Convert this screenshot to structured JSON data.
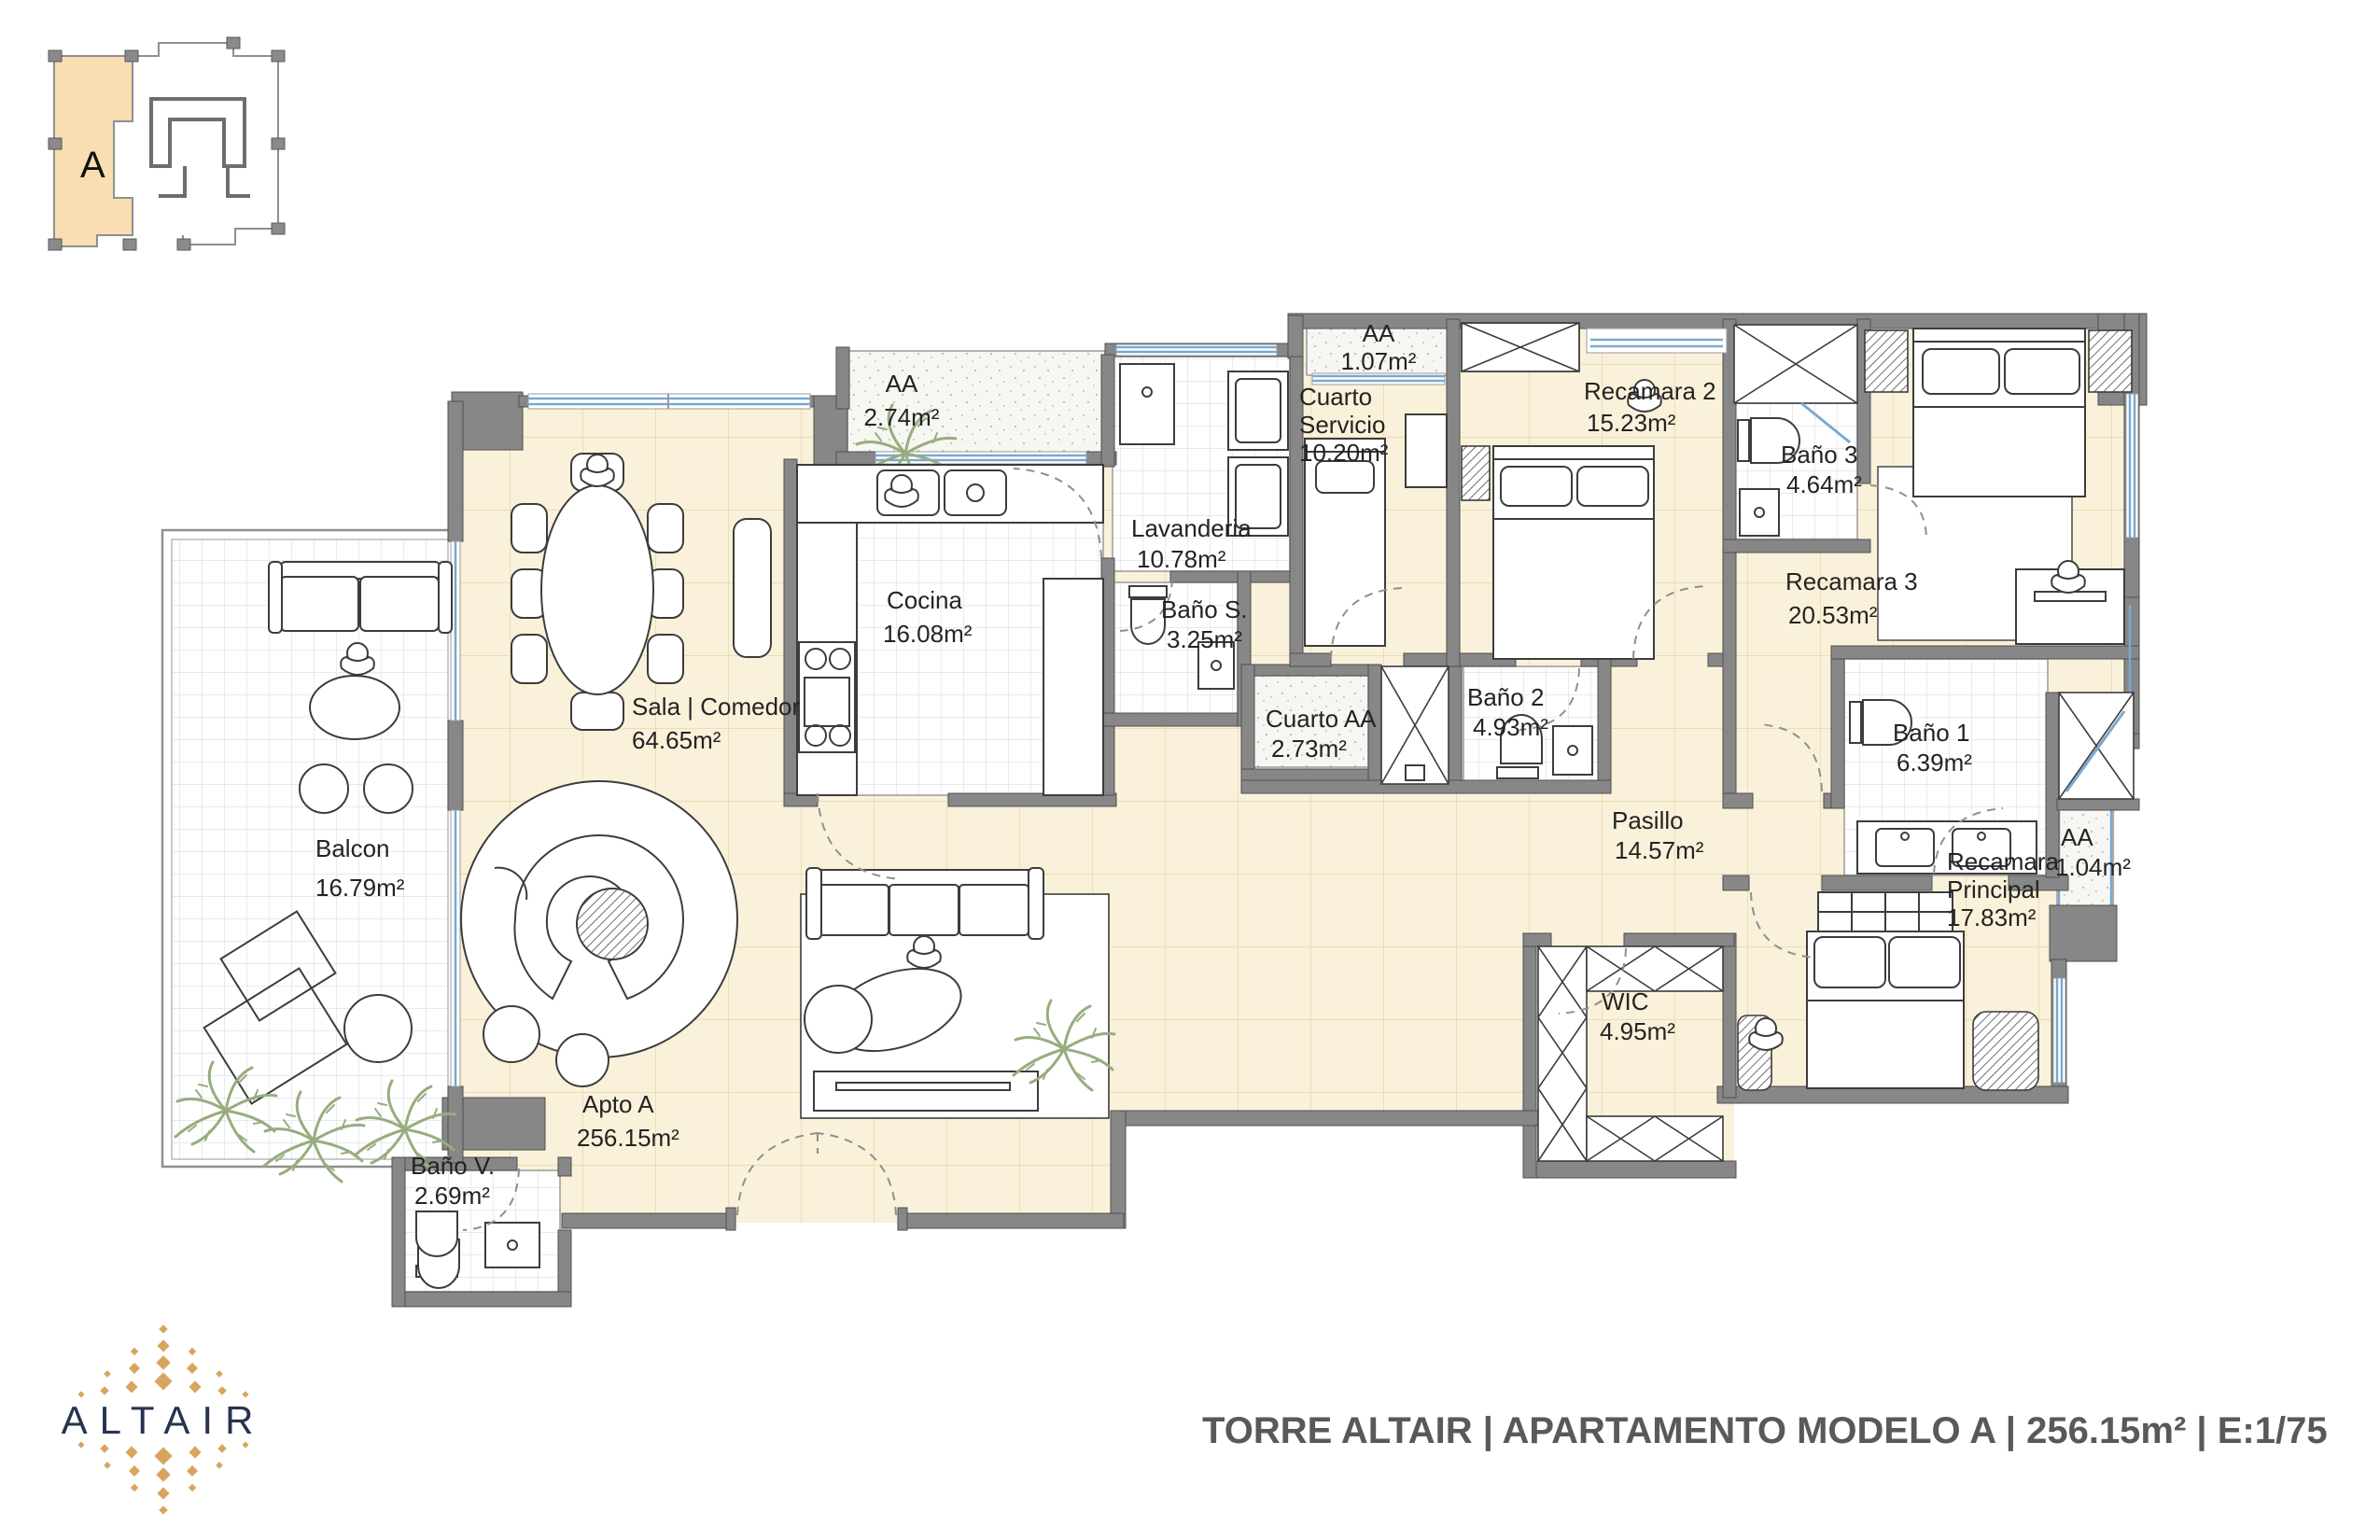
{
  "key_plan": {
    "unit_letter": "A"
  },
  "rooms": {
    "balcon": {
      "name": "Balcon",
      "area": "16.79m²"
    },
    "sala": {
      "name": "Sala | Comedor",
      "area": "64.65m²"
    },
    "aa_sala": {
      "name": "AA",
      "area": "2.74m²"
    },
    "cocina": {
      "name": "Cocina",
      "area": "16.08m²"
    },
    "lavanderia": {
      "name": "Lavanderia",
      "area": "10.78m²"
    },
    "bano_s": {
      "name": "Baño S.",
      "area": "3.25m²"
    },
    "aa_servicio": {
      "name": "AA",
      "area": "1.07m²"
    },
    "cuarto_servicio": {
      "name1": "Cuarto",
      "name2": "Servicio",
      "area": "10.20m²"
    },
    "recamara2": {
      "name": "Recamara 2",
      "area": "15.23m²"
    },
    "bano3": {
      "name": "Baño 3",
      "area": "4.64m²"
    },
    "recamara3": {
      "name": "Recamara 3",
      "area": "20.53m²"
    },
    "cuarto_aa": {
      "name": "Cuarto AA",
      "area": "2.73m²"
    },
    "bano2": {
      "name": "Baño 2",
      "area": "4.93m²"
    },
    "pasillo": {
      "name": "Pasillo",
      "area": "14.57m²"
    },
    "bano1": {
      "name": "Baño 1",
      "area": "6.39m²"
    },
    "aa_recamara": {
      "name": "AA",
      "area": "1.04m²"
    },
    "recamara_principal": {
      "name1": "Recamara",
      "name2": "Principal",
      "area": "17.83m²"
    },
    "wic": {
      "name": "WIC",
      "area": "4.95m²"
    },
    "apto": {
      "name": "Apto A",
      "area": "256.15m²"
    },
    "bano_v": {
      "name": "Baño V.",
      "area": "2.69m²"
    }
  },
  "footer": {
    "logo_text": "ALTAIR",
    "title": "TORRE ALTAIR | APARTAMENTO MODELO A | 256.15m² | E:1/75"
  },
  "colors": {
    "unit_fill": "#f8deb0",
    "floor_cream": "#faf1da",
    "wall_gray": "#878787",
    "window_blue": "#79a9d1",
    "logo_navy": "#26334f",
    "logo_gold": "#d9a55e",
    "title_gray": "#595959",
    "plant_green": "#97ad80"
  }
}
